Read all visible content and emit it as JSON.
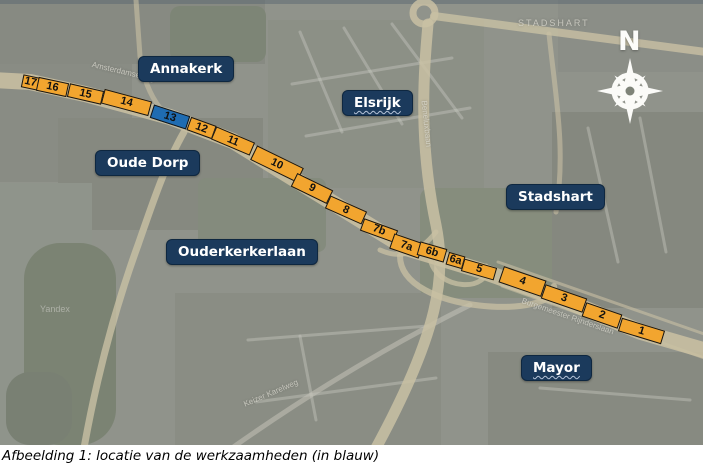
{
  "figure": {
    "caption": "Afbeelding 1: locatie van de werkzaamheden (in blauw)"
  },
  "map": {
    "compass": {
      "north_label": "N"
    },
    "watermark": "Yandex",
    "labels": [
      {
        "id": "annakerk",
        "text": "Annakerk"
      },
      {
        "id": "elsrijk",
        "text": "Elsrijk"
      },
      {
        "id": "oude-dorp",
        "text": "Oude Dorp"
      },
      {
        "id": "stadshart",
        "text": "Stadshart"
      },
      {
        "id": "ouderkerkerlaan",
        "text": "Ouderkerkerlaan"
      },
      {
        "id": "mayor",
        "text": "Mayor"
      }
    ],
    "street_names": [
      {
        "text": "Amsterdamseweg",
        "x": 92,
        "y": 60,
        "a": 13,
        "size": 8,
        "spacing": 0
      },
      {
        "text": "Beneluxbaan",
        "x": 424,
        "y": 96,
        "a": 84,
        "size": 8,
        "spacing": 0
      },
      {
        "text": "STADSHART",
        "x": 518,
        "y": 18,
        "a": 0,
        "size": 9,
        "spacing": 2
      },
      {
        "text": "Burgemeester Rijnderslaan",
        "x": 522,
        "y": 296,
        "a": 19,
        "size": 8,
        "spacing": 0
      },
      {
        "text": "Keizer Karelweg",
        "x": 244,
        "y": 400,
        "a": -23,
        "size": 8,
        "spacing": 0
      }
    ],
    "segments": [
      {
        "n": "17",
        "x": 30,
        "y": 82,
        "w": 17,
        "h": 13,
        "a": 12,
        "c": "orange"
      },
      {
        "n": "16",
        "x": 52,
        "y": 87,
        "w": 31,
        "h": 14,
        "a": 12,
        "c": "orange"
      },
      {
        "n": "15",
        "x": 85,
        "y": 94,
        "w": 35,
        "h": 14,
        "a": 13,
        "c": "orange"
      },
      {
        "n": "14",
        "x": 126,
        "y": 102,
        "w": 49,
        "h": 15,
        "a": 15,
        "c": "orange"
      },
      {
        "n": "13",
        "x": 170,
        "y": 117,
        "w": 38,
        "h": 14,
        "a": 18,
        "c": "blue"
      },
      {
        "n": "12",
        "x": 201,
        "y": 128,
        "w": 27,
        "h": 14,
        "a": 20,
        "c": "orange"
      },
      {
        "n": "11",
        "x": 233,
        "y": 141,
        "w": 42,
        "h": 14,
        "a": 23,
        "c": "orange"
      },
      {
        "n": "10",
        "x": 277,
        "y": 164,
        "w": 52,
        "h": 16,
        "a": 26,
        "c": "orange"
      },
      {
        "n": "9",
        "x": 312,
        "y": 188,
        "w": 40,
        "h": 15,
        "a": 26,
        "c": "orange"
      },
      {
        "n": "8",
        "x": 346,
        "y": 210,
        "w": 40,
        "h": 14,
        "a": 24,
        "c": "orange"
      },
      {
        "n": "7b",
        "x": 379,
        "y": 230,
        "w": 36,
        "h": 13,
        "a": 20,
        "c": "orange"
      },
      {
        "n": "7a",
        "x": 406,
        "y": 246,
        "w": 31,
        "h": 16,
        "a": 19,
        "c": "orange"
      },
      {
        "n": "6b",
        "x": 432,
        "y": 252,
        "w": 28,
        "h": 14,
        "a": 16,
        "c": "orange"
      },
      {
        "n": "6a",
        "x": 455,
        "y": 260,
        "w": 17,
        "h": 13,
        "a": 16,
        "c": "orange"
      },
      {
        "n": "5",
        "x": 479,
        "y": 269,
        "w": 34,
        "h": 13,
        "a": 16,
        "c": "orange"
      },
      {
        "n": "4",
        "x": 522,
        "y": 281,
        "w": 45,
        "h": 17,
        "a": 19,
        "c": "orange"
      },
      {
        "n": "3",
        "x": 564,
        "y": 298,
        "w": 44,
        "h": 15,
        "a": 19,
        "c": "orange"
      },
      {
        "n": "2",
        "x": 602,
        "y": 315,
        "w": 38,
        "h": 15,
        "a": 19,
        "c": "orange"
      },
      {
        "n": "1",
        "x": 641,
        "y": 331,
        "w": 45,
        "h": 14,
        "a": 17,
        "c": "orange"
      }
    ],
    "colors": {
      "work_section_blue": "#1f6cb2",
      "section_orange": "#f2a52f",
      "label_background": "#1b3a5c",
      "road_beige": "#e9d9ae"
    }
  }
}
